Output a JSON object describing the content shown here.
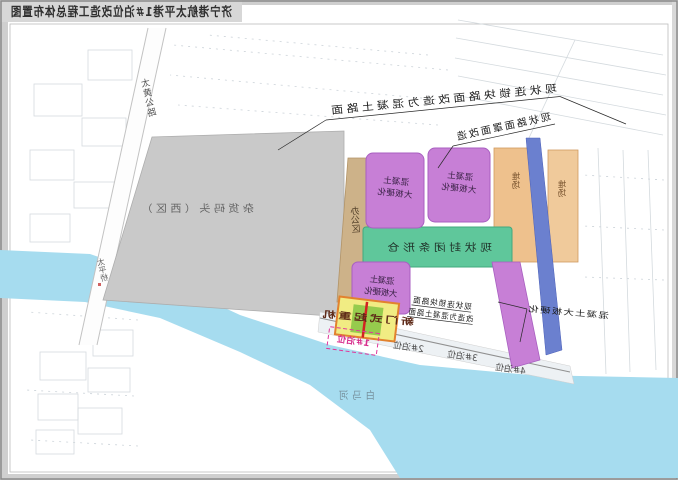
{
  "title": "济宁港航太平港1#泊位改造工程总体布置图",
  "labels": {
    "road": "太黄公路",
    "bridge": "太平桥",
    "river": "白马河",
    "wharf": "杂货码头（西区）",
    "office": "办公区",
    "shed": "现状封闭条形仓",
    "yard_a": "堆场",
    "yard_b": "堆场",
    "slab_line1": "混凝土",
    "slab_line2": "大板硬化",
    "crane": "新门式起重机"
  },
  "notes": {
    "pavement_full": "现状连锁块路面改造为混凝土路面",
    "pavement_partial": "现状路面罩面改造",
    "quay_line1": "现状连锁块路面",
    "quay_line2": "改造为混凝土路面",
    "slab_note": "混凝土大板硬化"
  },
  "berths": [
    {
      "id": "1#泊位"
    },
    {
      "id": "2#泊位"
    },
    {
      "id": "3#泊位"
    },
    {
      "id": "4#泊位"
    }
  ],
  "colors": {
    "river": "#a6dcef",
    "wharf_area": "#c9c9c9",
    "slab_block": "#c77fd6",
    "shed_block": "#5fc79b",
    "office_strip": "#cdb289",
    "yard_strip": "#eec18d",
    "conveyor_band": "#6b80cf",
    "crane_box": "#f1ec83",
    "crane_border": "#e2822e",
    "berth_highlight": "#e0359b"
  }
}
